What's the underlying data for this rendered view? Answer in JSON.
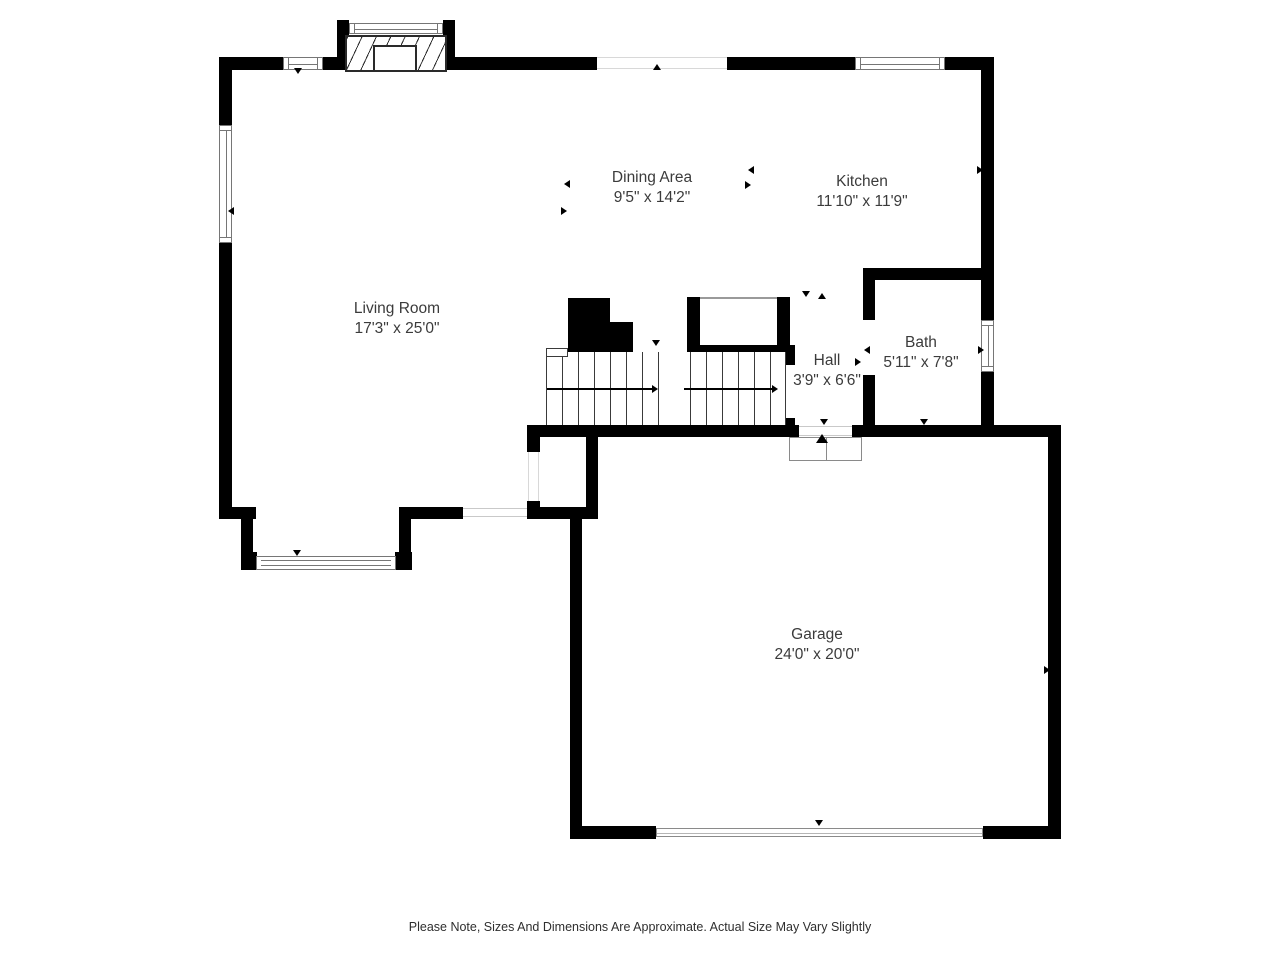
{
  "rooms": [
    {
      "id": "living-room",
      "name": "Living Room",
      "dimensions": "17'3\" x 25'0\""
    },
    {
      "id": "dining-area",
      "name": "Dining Area",
      "dimensions": "9'5\" x 14'2\""
    },
    {
      "id": "kitchen",
      "name": "Kitchen",
      "dimensions": "11'10\" x 11'9\""
    },
    {
      "id": "hall",
      "name": "Hall",
      "dimensions": "3'9\" x 6'6\""
    },
    {
      "id": "bath",
      "name": "Bath",
      "dimensions": "5'11\" x 7'8\""
    },
    {
      "id": "garage",
      "name": "Garage",
      "dimensions": "24'0\" x 20'0\""
    }
  ],
  "footer": {
    "note": "Please Note, Sizes And Dimensions Are Approximate. Actual Size May Vary Slightly"
  },
  "colors": {
    "wall": "#000000",
    "window_border": "#767676",
    "text": "#3b3b3b",
    "background": "#ffffff"
  }
}
